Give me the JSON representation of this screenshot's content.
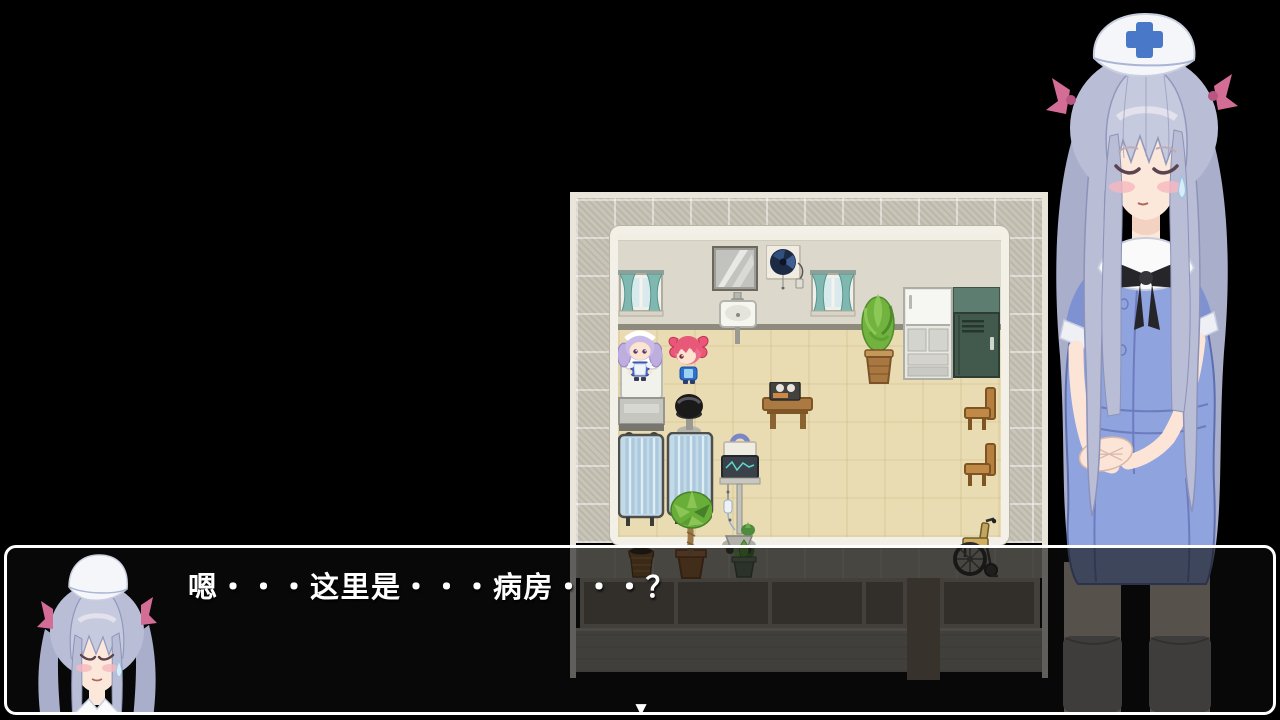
{
  "dialogue": {
    "text": "嗯・・・这里是・・・病房・・・？",
    "continue_glyph": "▼"
  },
  "scene": {
    "npcs": [
      "maid-silver-twintails",
      "girl-pink-twintails"
    ],
    "portrait_character": "nurse-silver-hair",
    "dialog_portrait": "nurse-bust"
  },
  "colors": {
    "dialog_border": "#ffffff",
    "dialog_text": "#ffffff",
    "dialog_bg": "rgba(13,13,13,0.62)",
    "map_frame": "#e9e5da",
    "map_tiles": "#c8c4b7",
    "room_wall": "#dcd8cc",
    "room_floor": "#e9dcb2",
    "curtain": "#7fb8b0",
    "nurse_hair": "#b9bdd6",
    "nurse_dress": "#8fa3de",
    "cap_cross": "#4a78c8",
    "hair_ribbon": "#d46d96"
  }
}
